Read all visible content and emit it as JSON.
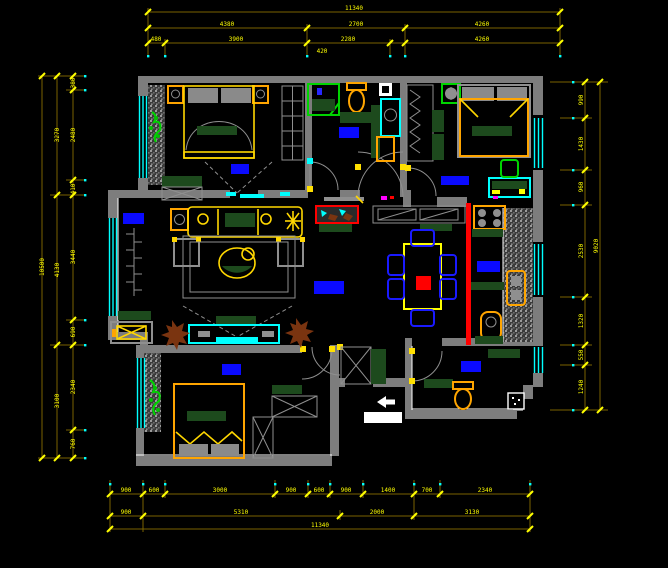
{
  "drawing": {
    "type": "apartment-floor-plan-cad",
    "background": "#000000",
    "units": "mm"
  },
  "palette": {
    "background": "#000000",
    "walls": "#7d7d7d",
    "dimension_text": "#ffff00",
    "dimension_line": "#7a6200",
    "window": "#00ffff",
    "room_label_block": "#0a0aff",
    "furniture_accent": "#ffa500",
    "textile_green": "#1d4a1d",
    "plant_green": "#00c000",
    "highlight_wall_red": "#ff0000",
    "plant_brown": "#7a3410",
    "entry_marker": "#ffffff"
  },
  "dimensions": {
    "top": {
      "total": "11340",
      "inner": [
        "4380",
        "2700",
        "4260"
      ],
      "detail": [
        "480",
        "3900",
        "2280",
        "420",
        "4260"
      ]
    },
    "bottom": {
      "detail": [
        "900",
        "600",
        "3000",
        "900",
        "600",
        "900",
        "1400",
        "700",
        "2340"
      ],
      "inner": [
        "900",
        "5310",
        "2000",
        "3130"
      ],
      "total": "11340"
    },
    "left": {
      "total": "10500",
      "inner": [
        "3270",
        "4130",
        "3100"
      ],
      "detail": [
        "380",
        "2480",
        "410",
        "3440",
        "690",
        "2340",
        "760"
      ]
    },
    "right": {
      "total": "9020",
      "detail": [
        "990",
        "1430",
        "960",
        "2530",
        "1320",
        "550",
        "1240"
      ]
    }
  },
  "rooms": [
    {
      "id": "bedroom-top-left",
      "label_block": true,
      "furniture": [
        "double-bed",
        "nightstand-left",
        "nightstand-right",
        "wardrobe",
        "dresser",
        "plant"
      ]
    },
    {
      "id": "bathroom-top",
      "label_block": true,
      "furniture": [
        "shower-enclosure",
        "toilet",
        "washbasin",
        "cabinet",
        "shelf"
      ]
    },
    {
      "id": "bedroom-top-right",
      "label_block": true,
      "furniture": [
        "double-bed",
        "wardrobe",
        "desk",
        "chair",
        "vent-fan"
      ]
    },
    {
      "id": "living-room",
      "label_block": true,
      "furniture": [
        "sofa",
        "armchair-left",
        "armchair-right",
        "coffee-table",
        "tv-cabinet",
        "tv",
        "radiator",
        "plant-left",
        "plant-right",
        "side-table",
        "balcony-bench"
      ]
    },
    {
      "id": "dining-room",
      "label_block": false,
      "furniture": [
        "dining-table",
        "six-chairs",
        "sideboard",
        "aquarium"
      ]
    },
    {
      "id": "kitchen",
      "label_block": true,
      "furniture": [
        "stove",
        "hatched-counter",
        "sink",
        "water-heater"
      ]
    },
    {
      "id": "hallway",
      "label_block": true,
      "furniture": []
    },
    {
      "id": "bedroom-bottom-left",
      "label_block": true,
      "furniture": [
        "double-bed",
        "wardrobe-upper",
        "wardrobe-lower",
        "plant"
      ]
    },
    {
      "id": "bathroom-bottom",
      "label_block": true,
      "furniture": [
        "toilet",
        "vanity-counter",
        "floor-drain"
      ]
    },
    {
      "id": "entry",
      "label_block": false,
      "furniture": [
        "shoe-cabinet",
        "entry-arrow",
        "entry-name-plate"
      ]
    }
  ]
}
